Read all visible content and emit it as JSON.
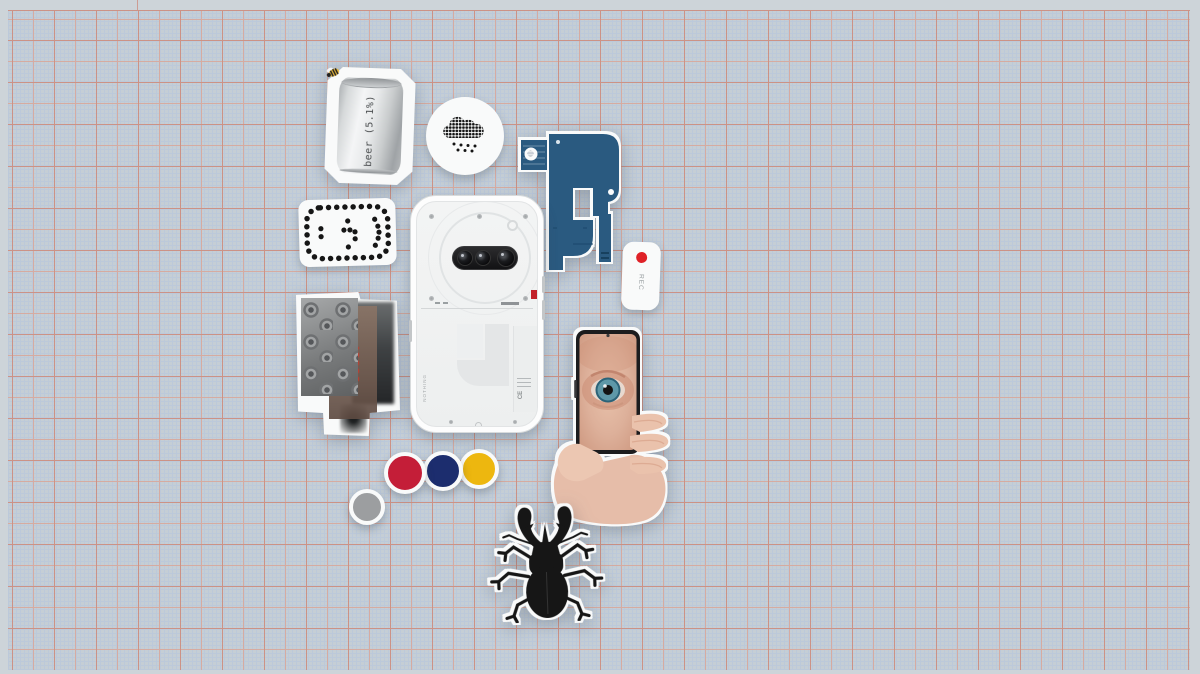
{
  "canvas": {
    "width": 1200,
    "height": 674,
    "background": "graph-paper"
  },
  "colors": {
    "margin": "#cdd4d9",
    "paper": "#c5ced5",
    "grid_minor": "#bcc9da",
    "grid_mid": "#d6aba1",
    "grid_major": "#cc9286",
    "sticker_white": "#f9fafa",
    "flex_blue": "#2a5a80",
    "rec_red": "#df2127",
    "accent_red": "#c2222a",
    "dot_gray": "#9c9ea0",
    "dot_red": "#c41e38",
    "dot_navy": "#1c2d6e",
    "dot_yellow": "#edb70f",
    "ink": "#161616",
    "skin": "#e6bda9",
    "iris": "#5e98a8",
    "can_text": "#4a4d4f"
  },
  "stickers": {
    "beer_can": {
      "label": "beer (5.1%)",
      "icon": "bee-icon"
    },
    "weather_badge": {
      "icon": "pixel-cloud-rain-icon"
    },
    "flex_cable": {
      "icon": "blue-flex-cable-icon"
    },
    "dot_matrix": {
      "icon": "dot-matrix-frame-icon"
    },
    "phone": {
      "brand": "NOTHING",
      "cert_mark": "CE"
    },
    "rec_pill": {
      "label": "REC",
      "icon": "record-dot-icon"
    },
    "tentacle_collage": {
      "icon": "tentacle-photo-collage"
    },
    "hand_eye": {
      "icon": "hand-holding-phone-eye"
    },
    "color_dots": {
      "items": [
        "gray",
        "red",
        "navy",
        "yellow"
      ]
    },
    "beetle": {
      "icon": "stag-beetle-icon"
    }
  }
}
